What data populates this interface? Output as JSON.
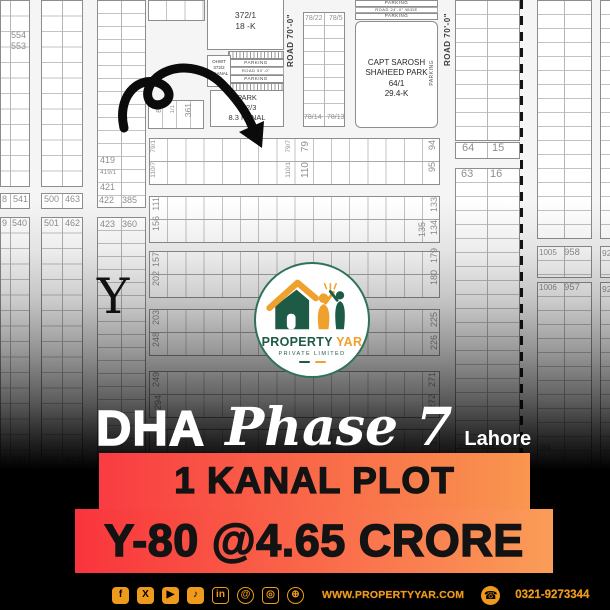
{
  "colors": {
    "brand_green": "#1E5B47",
    "brand_orange": "#EFA12D",
    "banner_red": "#F9343C",
    "banner_orange": "#FA9D58",
    "footer_orange": "#ED9A1D"
  },
  "logo": {
    "name_part1": "PROPERTY",
    "name_part2": "YAR",
    "subtitle": "PRIVATE LIMITED"
  },
  "headline": {
    "dha": "DHA",
    "phase": "Phase 7",
    "city": "Lahore"
  },
  "offer": {
    "line1": "1 KANAL PLOT",
    "line2": "Y-80 @4.65 CRORE"
  },
  "footer": {
    "website": "WWW.PROPERTYYAR.COM",
    "phone": "0321-9273344",
    "phone_icon": "☎",
    "icons": [
      {
        "name": "facebook-icon",
        "glyph": "f",
        "variant": "fill"
      },
      {
        "name": "x-icon",
        "glyph": "X",
        "variant": "fill"
      },
      {
        "name": "youtube-icon",
        "glyph": "▶",
        "variant": "fill"
      },
      {
        "name": "tiktok-icon",
        "glyph": "♪",
        "variant": "fill"
      },
      {
        "name": "linkedin-icon",
        "glyph": "in",
        "variant": "outline"
      },
      {
        "name": "threads-icon",
        "glyph": "@",
        "variant": "outline round"
      },
      {
        "name": "instagram-icon",
        "glyph": "◎",
        "variant": "outline"
      },
      {
        "name": "globe-icon",
        "glyph": "⊕",
        "variant": "outline round"
      }
    ]
  },
  "map": {
    "section_letter": "Y",
    "roads": {
      "road70_a": "ROAD 70'-0\"",
      "road70_b": "ROAD 70'-0\"",
      "road50": "ROAD 50'-0\"",
      "road24": "ROAD 24'-0\" WIDE",
      "parking_top1": "PARKING",
      "parking_top2": "PARKING",
      "parking_mid1": "PARKING",
      "parking_mid2": "PARKING",
      "parking_side": "PARKING"
    },
    "blocks": {
      "plot372": {
        "line1": "372/1",
        "line2": "18 -K"
      },
      "ohwt": {
        "line1": "OHWT",
        "line2": "372/2",
        "line3": "1 KANAL"
      },
      "park372": {
        "line1": "PARK",
        "line2": "372/3",
        "line3": "8.3 KANAL"
      },
      "captpark": {
        "line1": "CAPT SAROSH",
        "line2": "SHAHEED PARK",
        "line3": "64/1",
        "line4": "29.4-K"
      }
    },
    "plot_labels": [
      {
        "t": "554",
        "x": 11,
        "y": 31,
        "fs": 9
      },
      {
        "t": "553",
        "x": 11,
        "y": 42,
        "fs": 9
      },
      {
        "t": "8",
        "x": 2,
        "y": 195,
        "fs": 9
      },
      {
        "t": "541",
        "x": 13,
        "y": 195,
        "fs": 9
      },
      {
        "t": "500",
        "x": 44,
        "y": 195,
        "fs": 9
      },
      {
        "t": "463",
        "x": 65,
        "y": 195,
        "fs": 9
      },
      {
        "t": "9",
        "x": 2,
        "y": 219,
        "fs": 9
      },
      {
        "t": "540",
        "x": 12,
        "y": 219,
        "fs": 9
      },
      {
        "t": "501",
        "x": 44,
        "y": 219,
        "fs": 9
      },
      {
        "t": "462",
        "x": 65,
        "y": 219,
        "fs": 9
      },
      {
        "t": "419",
        "x": 100,
        "y": 156,
        "fs": 9
      },
      {
        "t": "419/1",
        "x": 100,
        "y": 170,
        "fs": 6.5
      },
      {
        "t": "421",
        "x": 100,
        "y": 183,
        "fs": 9
      },
      {
        "t": "422",
        "x": 99,
        "y": 196,
        "fs": 9
      },
      {
        "t": "385",
        "x": 122,
        "y": 196,
        "fs": 9
      },
      {
        "t": "423",
        "x": 100,
        "y": 220,
        "fs": 9
      },
      {
        "t": "360",
        "x": 122,
        "y": 220,
        "fs": 9
      },
      {
        "t": "78/22",
        "x": 305,
        "y": 15,
        "fs": 7
      },
      {
        "t": "78/5",
        "x": 329,
        "y": 15,
        "fs": 7
      },
      {
        "t": "78/14",
        "x": 304,
        "y": 114,
        "fs": 7
      },
      {
        "t": "78/13",
        "x": 327,
        "y": 114,
        "fs": 7
      },
      {
        "t": "64",
        "x": 462,
        "y": 143,
        "fs": 11
      },
      {
        "t": "15",
        "x": 492,
        "y": 143,
        "fs": 11
      },
      {
        "t": "63",
        "x": 461,
        "y": 169,
        "fs": 11
      },
      {
        "t": "16",
        "x": 490,
        "y": 169,
        "fs": 11
      },
      {
        "t": "1005",
        "x": 539,
        "y": 249,
        "fs": 8
      },
      {
        "t": "958",
        "x": 564,
        "y": 248,
        "fs": 9.5
      },
      {
        "t": "1006",
        "x": 539,
        "y": 284,
        "fs": 8
      },
      {
        "t": "957",
        "x": 564,
        "y": 283,
        "fs": 9.5
      },
      {
        "t": "8",
        "x": 2,
        "y": 456,
        "fs": 9
      },
      {
        "t": "521",
        "x": 12,
        "y": 456,
        "fs": 9
      },
      {
        "t": "520",
        "x": 43,
        "y": 456,
        "fs": 9
      },
      {
        "t": "443",
        "x": 65,
        "y": 456,
        "fs": 9
      },
      {
        "t": "1019",
        "x": 457,
        "y": 444,
        "fs": 7
      },
      {
        "t": "944",
        "x": 481,
        "y": 443,
        "fs": 8.5
      },
      {
        "t": "1019/1",
        "x": 456,
        "y": 457,
        "fs": 6
      },
      {
        "t": "943/2",
        "x": 481,
        "y": 457,
        "fs": 7
      },
      {
        "t": "94",
        "x": 541,
        "y": 443,
        "fs": 8.5
      },
      {
        "t": "92",
        "x": 602,
        "y": 249,
        "fs": 8.5
      },
      {
        "t": "92",
        "x": 602,
        "y": 285,
        "fs": 8.5
      },
      {
        "t": "79/1",
        "x": 151,
        "y": 140,
        "v": 1,
        "fs": 6.5
      },
      {
        "t": "110/7",
        "x": 151,
        "y": 162,
        "v": 1,
        "fs": 6.5
      },
      {
        "t": "79/7",
        "x": 286,
        "y": 140,
        "v": 1,
        "fs": 6.5
      },
      {
        "t": "110/1",
        "x": 286,
        "y": 162,
        "v": 1,
        "fs": 6.5
      },
      {
        "t": "79",
        "x": 301,
        "y": 141,
        "v": 1,
        "fs": 10
      },
      {
        "t": "110",
        "x": 301,
        "y": 162,
        "v": 1,
        "fs": 10
      },
      {
        "t": "94",
        "x": 428,
        "y": 140,
        "v": 1,
        "fs": 9
      },
      {
        "t": "95",
        "x": 428,
        "y": 162,
        "v": 1,
        "fs": 9
      },
      {
        "t": "111",
        "x": 152,
        "y": 197,
        "v": 1,
        "fs": 9
      },
      {
        "t": "156",
        "x": 152,
        "y": 216,
        "v": 1,
        "fs": 9
      },
      {
        "t": "135",
        "x": 418,
        "y": 222,
        "v": 1,
        "fs": 9
      },
      {
        "t": "133",
        "x": 430,
        "y": 197,
        "v": 1,
        "fs": 9
      },
      {
        "t": "134",
        "x": 430,
        "y": 220,
        "v": 1,
        "fs": 9
      },
      {
        "t": "157",
        "x": 152,
        "y": 252,
        "v": 1,
        "fs": 9
      },
      {
        "t": "202",
        "x": 152,
        "y": 271,
        "v": 1,
        "fs": 9
      },
      {
        "t": "179",
        "x": 430,
        "y": 248,
        "v": 1,
        "fs": 9
      },
      {
        "t": "180",
        "x": 430,
        "y": 270,
        "v": 1,
        "fs": 9
      },
      {
        "t": "203",
        "x": 152,
        "y": 310,
        "v": 1,
        "fs": 9
      },
      {
        "t": "248",
        "x": 152,
        "y": 332,
        "v": 1,
        "fs": 9
      },
      {
        "t": "225",
        "x": 430,
        "y": 312,
        "v": 1,
        "fs": 9
      },
      {
        "t": "226",
        "x": 430,
        "y": 335,
        "v": 1,
        "fs": 9
      },
      {
        "t": "249",
        "x": 152,
        "y": 372,
        "v": 1,
        "fs": 9
      },
      {
        "t": "294",
        "x": 154,
        "y": 395,
        "v": 1,
        "fs": 9
      },
      {
        "t": "271",
        "x": 428,
        "y": 372,
        "v": 1,
        "fs": 9
      },
      {
        "t": "272",
        "x": 428,
        "y": 394,
        "v": 1,
        "fs": 9
      },
      {
        "t": "295",
        "x": 154,
        "y": 431,
        "v": 1,
        "fs": 9
      },
      {
        "t": "317",
        "x": 430,
        "y": 431,
        "v": 1,
        "fs": 9
      },
      {
        "t": "84",
        "x": 156,
        "y": 105,
        "v": 1,
        "fs": 7
      },
      {
        "t": "1/1",
        "x": 170,
        "y": 105,
        "v": 1,
        "fs": 6
      },
      {
        "t": "361",
        "x": 184,
        "y": 103,
        "v": 1,
        "fs": 8.5
      }
    ]
  }
}
